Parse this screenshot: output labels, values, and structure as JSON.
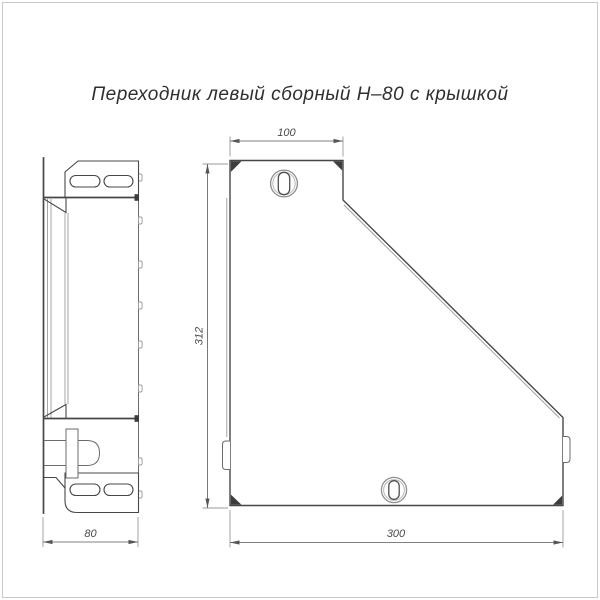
{
  "title": "Переходник левый сборный Н–80 с крышкой",
  "colors": {
    "background": "#ffffff",
    "frame": "#c9c9c9",
    "line_main": "#474747",
    "line_thin": "#9a9a9a",
    "line_dim": "#565656"
  },
  "dimensions": {
    "top_width": "100",
    "height": "312",
    "bottom_width": "300",
    "side_depth": "80"
  }
}
